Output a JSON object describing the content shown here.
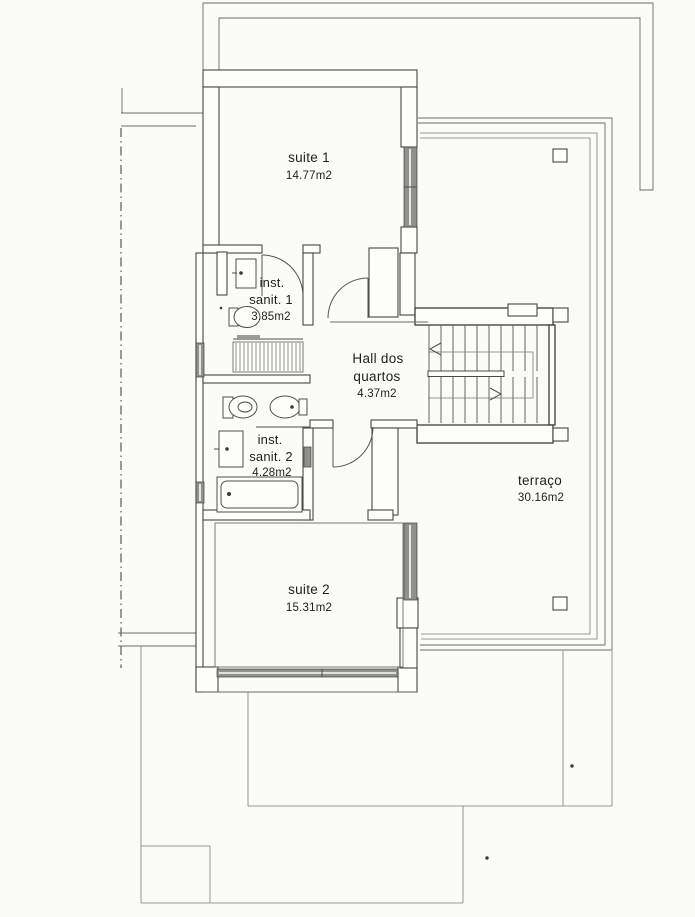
{
  "colors": {
    "paper": "#fbfbf8",
    "ink": "#474747",
    "window_fill": "#8e918e"
  },
  "rooms": {
    "suite1": {
      "label": "suite 1",
      "area": "14.77m2"
    },
    "sanit1": {
      "label_line1": "inst.",
      "label_line2": "sanit. 1",
      "area": "3.85m2"
    },
    "hall": {
      "label_line1": "Hall dos",
      "label_line2": "quartos",
      "area": "4.37m2"
    },
    "sanit2": {
      "label_line1": "inst.",
      "label_line2": "sanit. 2",
      "area": "4.28m2"
    },
    "suite2": {
      "label": "suite 2",
      "area": "15.31m2"
    },
    "terraco": {
      "label": "terraço",
      "area": "30.16m2"
    }
  }
}
